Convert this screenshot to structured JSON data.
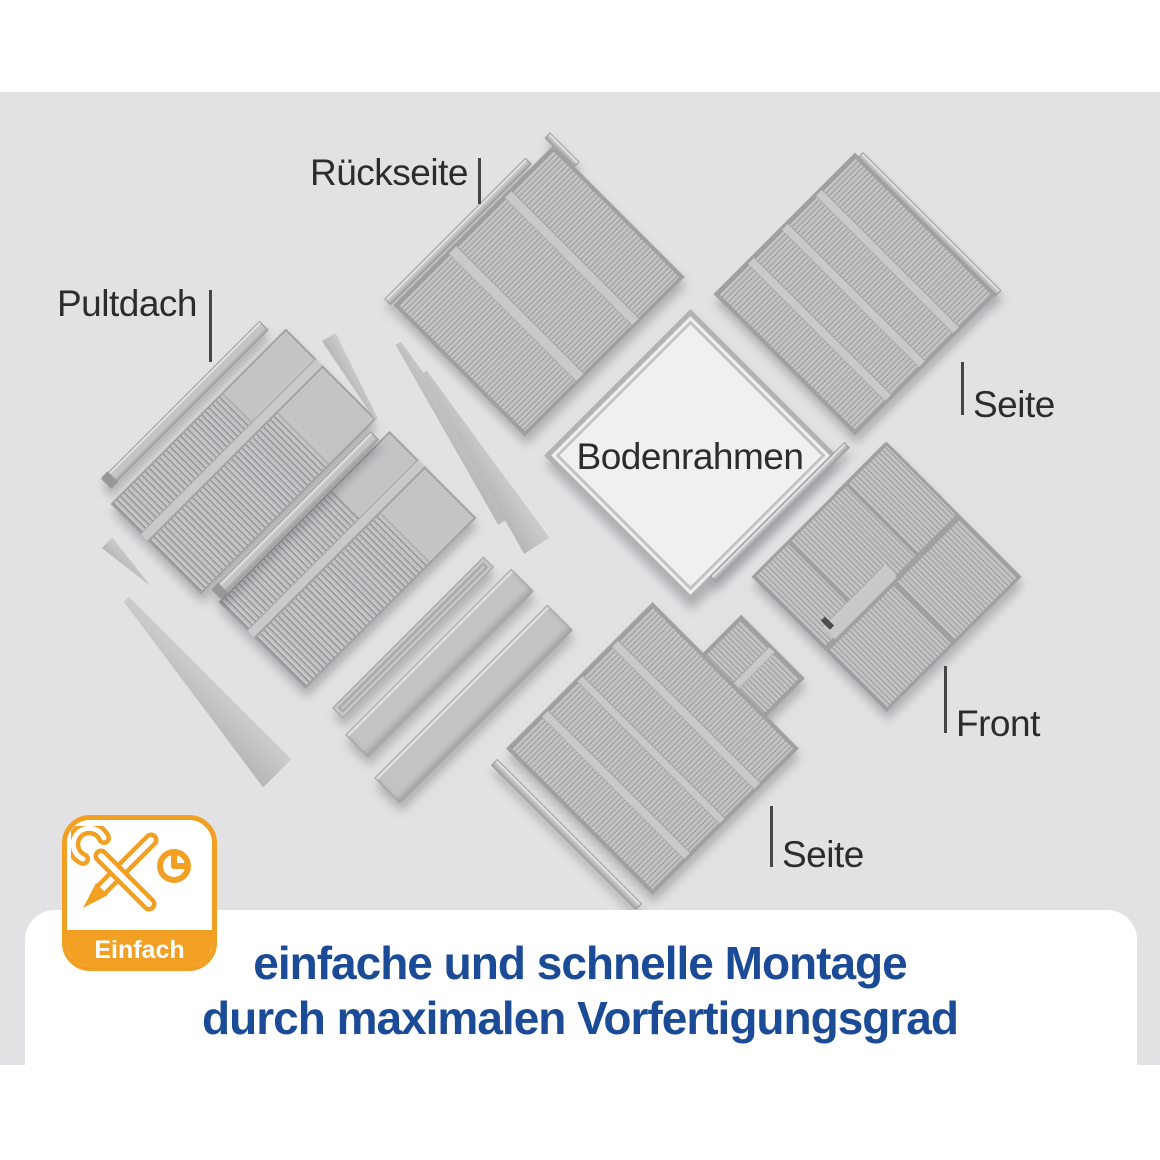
{
  "scene": {
    "labels": {
      "pultdach": "Pultdach",
      "rueckseite": "Rückseite",
      "seite_top": "Seite",
      "bodenrahmen": "Bodenrahmen",
      "front": "Front",
      "seite_bottom": "Seite"
    }
  },
  "badge": {
    "label": "Einfach",
    "icon": "tools-and-clock-icon"
  },
  "caption": {
    "line1": "einfache und schnelle Montage",
    "line2": "durch maximalen Vorfertigungsgrad"
  },
  "colors": {
    "background_gray": "#e2e2e4",
    "panel_gray": "#bcbcbe",
    "accent_orange": "#f2a024",
    "caption_blue": "#1b4b96",
    "label_dark": "#2c2c2e"
  }
}
